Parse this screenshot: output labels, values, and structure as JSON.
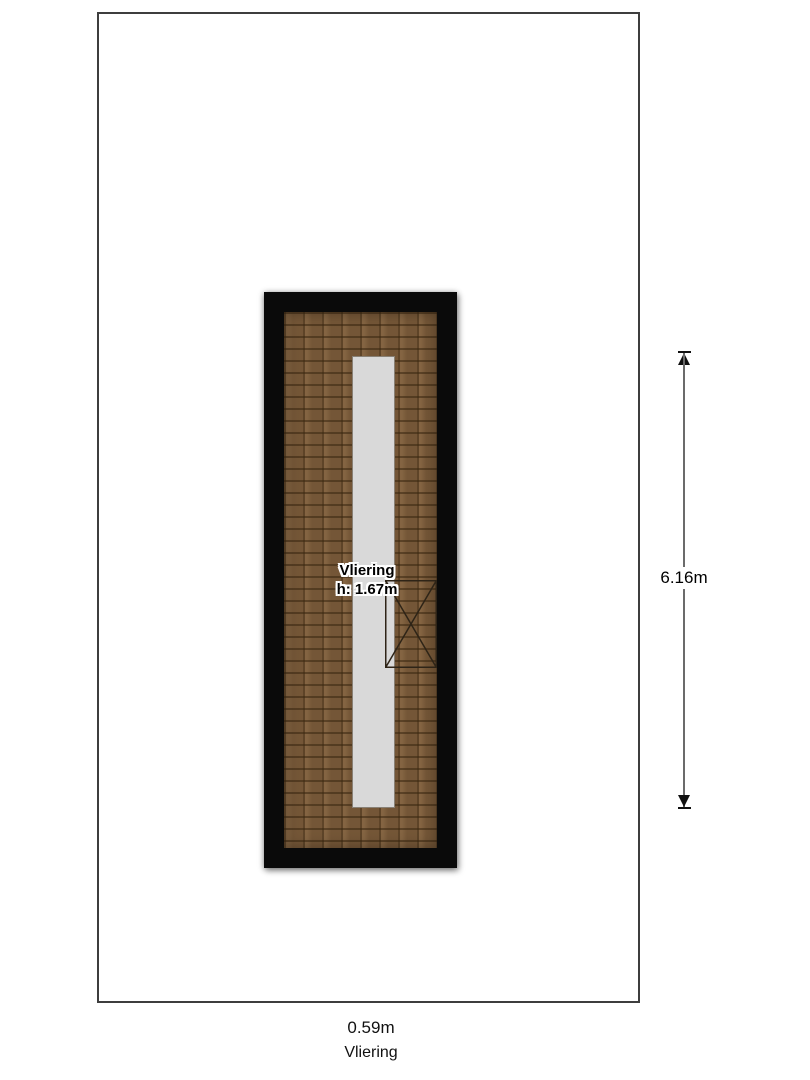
{
  "plan": {
    "room": {
      "label": "Vliering",
      "height_label": "h: 1.67m"
    },
    "dimension_vertical": {
      "label": "6.16m"
    },
    "footer": {
      "width_label": "0.59m",
      "room_name": "Vliering"
    },
    "colors": {
      "page_background": "#ffffff",
      "page_border": "#3e3e3e",
      "wall": "#0a0a0a",
      "floor_wood_base": "#7d5d3b",
      "floor_wood_joints": "#5c4226",
      "loft_strip": "#d9d9d9",
      "dimension_line": "#6b6b6b",
      "dimension_arrow": "#111111",
      "label_text": "#000000",
      "label_halo": "#ffffff"
    },
    "icons": {
      "dimension_top": "arrow-up-icon",
      "dimension_bottom": "arrow-down-icon",
      "hatch": "x-cross-marker-icon"
    }
  }
}
